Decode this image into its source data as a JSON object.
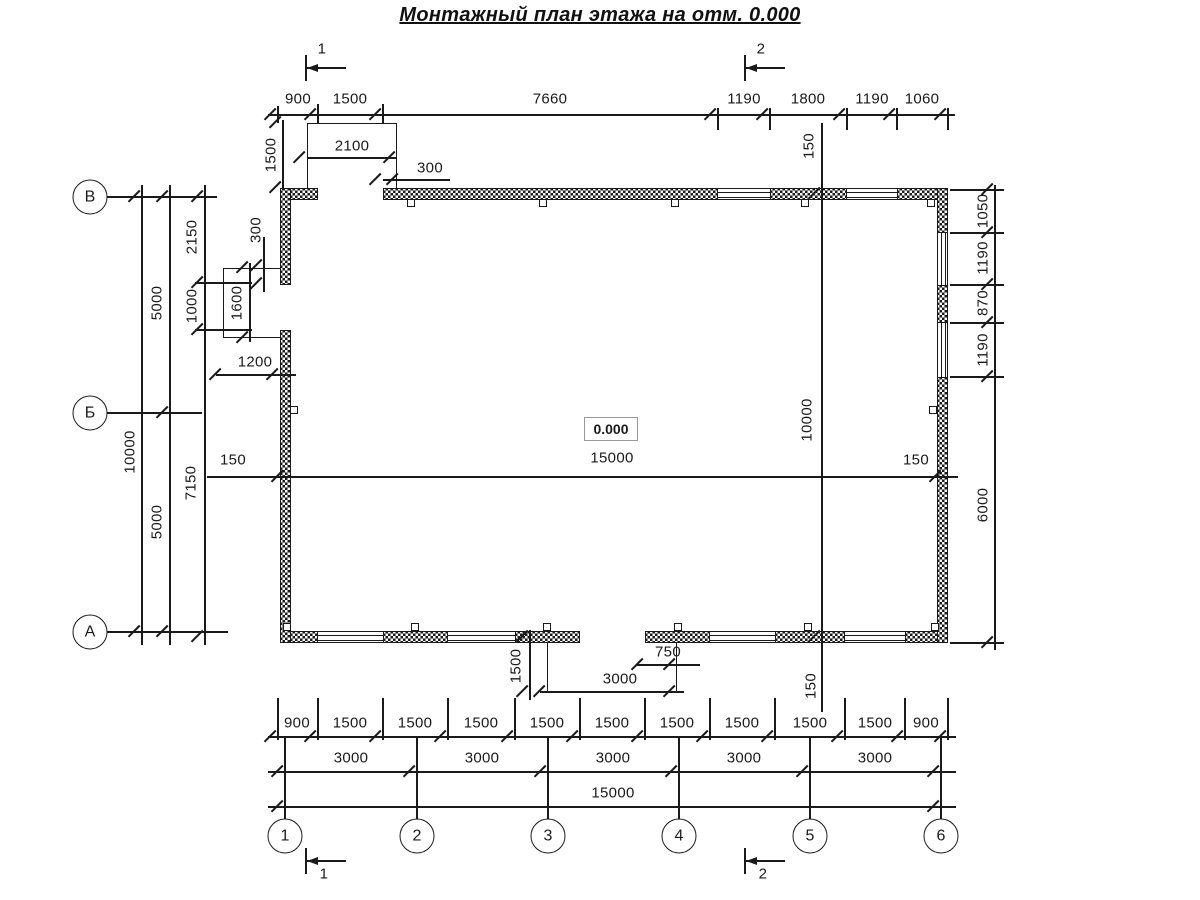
{
  "title": "Монтажный план этажа на отм. 0.000",
  "elevation_marker": "0.000",
  "axis_labels": {
    "rows": [
      "В",
      "Б",
      "А"
    ],
    "columns": [
      "1",
      "2",
      "3",
      "4",
      "5",
      "6"
    ]
  },
  "section_marks": {
    "top": [
      "1",
      "2"
    ],
    "bottom": [
      "1",
      "2"
    ]
  },
  "dimensions_mm": {
    "top_row": [
      "900",
      "1500",
      "7660",
      "1190",
      "1800",
      "1190",
      "1060"
    ],
    "top_porch": {
      "width": "2100",
      "depth": "1500",
      "offset": "300"
    },
    "left_outer_total": "10000",
    "left_outer_spans": [
      "5000",
      "5000"
    ],
    "left_detail": [
      "2150",
      "1000",
      "7150"
    ],
    "left_porch": {
      "height": "1600",
      "width": "1200",
      "offset": "300"
    },
    "right_outer": [
      "1050",
      "1190",
      "870",
      "1190",
      "6000"
    ],
    "interior_width": "15000",
    "interior_height": "10000",
    "wall_axis_offsets": [
      "150",
      "150",
      "150",
      "150"
    ],
    "bottom_porch": {
      "depth": "1500",
      "offset": "750",
      "width": "3000"
    },
    "bottom_row_1": [
      "900",
      "1500",
      "1500",
      "1500",
      "1500",
      "1500",
      "1500",
      "1500",
      "1500",
      "1500",
      "900"
    ],
    "bottom_row_2": [
      "3000",
      "3000",
      "3000",
      "3000",
      "3000"
    ],
    "bottom_row_3": [
      "15000"
    ]
  },
  "colors": {
    "line": "#1a1a1a",
    "background": "#ffffff",
    "elevation_box_border": "#9a9a9a"
  },
  "circles": [
    {
      "t": "В",
      "x": 90,
      "y": 197
    },
    {
      "t": "Б",
      "x": 90,
      "y": 413
    },
    {
      "t": "А",
      "x": 90,
      "y": 632
    },
    {
      "t": "1",
      "x": 285,
      "y": 836
    },
    {
      "t": "2",
      "x": 417,
      "y": 836
    },
    {
      "t": "3",
      "x": 548,
      "y": 836
    },
    {
      "t": "4",
      "x": 679,
      "y": 836
    },
    {
      "t": "5",
      "x": 810,
      "y": 836
    },
    {
      "t": "6",
      "x": 941,
      "y": 836
    }
  ],
  "labels": [
    {
      "t": "1",
      "x": 322,
      "y": 49,
      "n": "section-label-top-1"
    },
    {
      "t": "2",
      "x": 761,
      "y": 49,
      "n": "section-label-top-2"
    },
    {
      "t": "900",
      "x": 298,
      "y": 99
    },
    {
      "t": "1500",
      "x": 350,
      "y": 99
    },
    {
      "t": "7660",
      "x": 550,
      "y": 99
    },
    {
      "t": "1190",
      "x": 744,
      "y": 99
    },
    {
      "t": "1800",
      "x": 808,
      "y": 99
    },
    {
      "t": "1190",
      "x": 872,
      "y": 99
    },
    {
      "t": "1060",
      "x": 922,
      "y": 99
    },
    {
      "t": "2100",
      "x": 352,
      "y": 146
    },
    {
      "t": "1500",
      "x": 271,
      "y": 155,
      "r": 1
    },
    {
      "t": "300",
      "x": 430,
      "y": 168
    },
    {
      "t": "150",
      "x": 809,
      "y": 146,
      "r": 1
    },
    {
      "t": "2150",
      "x": 192,
      "y": 237,
      "r": 1
    },
    {
      "t": "300",
      "x": 256,
      "y": 230,
      "r": 1
    },
    {
      "t": "1000",
      "x": 192,
      "y": 306,
      "r": 1
    },
    {
      "t": "1600",
      "x": 237,
      "y": 303,
      "r": 1
    },
    {
      "t": "1200",
      "x": 255,
      "y": 362
    },
    {
      "t": "5000",
      "x": 157,
      "y": 303,
      "r": 1
    },
    {
      "t": "10000",
      "x": 130,
      "y": 452,
      "r": 1
    },
    {
      "t": "5000",
      "x": 157,
      "y": 522,
      "r": 1
    },
    {
      "t": "7150",
      "x": 191,
      "y": 483,
      "r": 1
    },
    {
      "t": "1050",
      "x": 983,
      "y": 211,
      "r": 1
    },
    {
      "t": "1190",
      "x": 983,
      "y": 258,
      "r": 1
    },
    {
      "t": "870",
      "x": 983,
      "y": 303,
      "r": 1
    },
    {
      "t": "1190",
      "x": 983,
      "y": 350,
      "r": 1
    },
    {
      "t": "6000",
      "x": 983,
      "y": 505,
      "r": 1
    },
    {
      "t": "150",
      "x": 233,
      "y": 460
    },
    {
      "t": "15000",
      "x": 612,
      "y": 458
    },
    {
      "t": "150",
      "x": 916,
      "y": 460
    },
    {
      "t": "10000",
      "x": 807,
      "y": 420,
      "r": 1
    },
    {
      "t": "150",
      "x": 811,
      "y": 686,
      "r": 1
    },
    {
      "t": "1500",
      "x": 516,
      "y": 666,
      "r": 1
    },
    {
      "t": "750",
      "x": 668,
      "y": 652
    },
    {
      "t": "3000",
      "x": 620,
      "y": 679
    },
    {
      "t": "900",
      "x": 297,
      "y": 723
    },
    {
      "t": "1500",
      "x": 350,
      "y": 723
    },
    {
      "t": "1500",
      "x": 415,
      "y": 723
    },
    {
      "t": "1500",
      "x": 481,
      "y": 723
    },
    {
      "t": "1500",
      "x": 547,
      "y": 723
    },
    {
      "t": "1500",
      "x": 612,
      "y": 723
    },
    {
      "t": "1500",
      "x": 677,
      "y": 723
    },
    {
      "t": "1500",
      "x": 742,
      "y": 723
    },
    {
      "t": "1500",
      "x": 810,
      "y": 723
    },
    {
      "t": "1500",
      "x": 875,
      "y": 723
    },
    {
      "t": "900",
      "x": 926,
      "y": 723
    },
    {
      "t": "3000",
      "x": 351,
      "y": 758
    },
    {
      "t": "3000",
      "x": 482,
      "y": 758
    },
    {
      "t": "3000",
      "x": 613,
      "y": 758
    },
    {
      "t": "3000",
      "x": 744,
      "y": 758
    },
    {
      "t": "3000",
      "x": 875,
      "y": 758
    },
    {
      "t": "15000",
      "x": 613,
      "y": 793
    },
    {
      "t": "1",
      "x": 324,
      "y": 874,
      "n": "section-label-bottom-1"
    },
    {
      "t": "2",
      "x": 763,
      "y": 874,
      "n": "section-label-bottom-2"
    }
  ]
}
